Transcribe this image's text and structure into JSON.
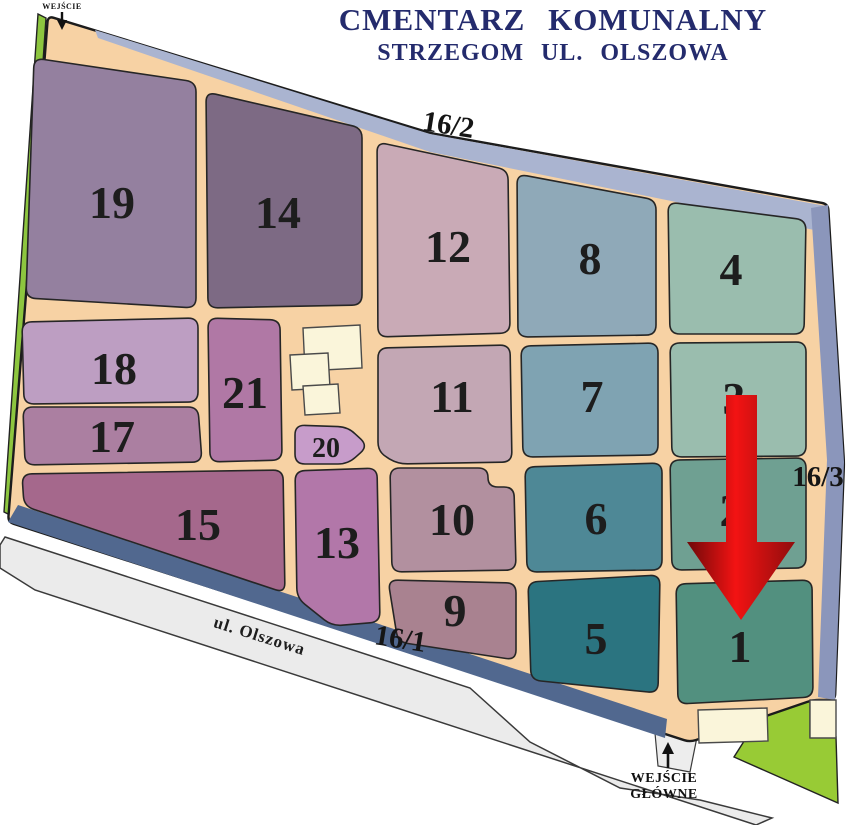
{
  "title": {
    "line1": "CMENTARZ KOMUNALNY",
    "line2": "STRZEGOM UL. OLSZOWA",
    "color": "#242b6d"
  },
  "map": {
    "ground_color": "#f7d2a4",
    "outline_color": "#1c1c1c",
    "number_color": "#1d1d1d",
    "boundary": [
      [
        48,
        16
      ],
      [
        430,
        133
      ],
      [
        828,
        204
      ],
      [
        844,
        462
      ],
      [
        835,
        700
      ],
      [
        813,
        700
      ],
      [
        690,
        742
      ],
      [
        8,
        522
      ]
    ],
    "strips": [
      {
        "name": "north-road-strip",
        "color": "#aab4d0",
        "points": [
          [
            95,
            30
          ],
          [
            430,
            134
          ],
          [
            826,
            206
          ],
          [
            824,
            232
          ],
          [
            430,
            152
          ],
          [
            98,
            38
          ]
        ]
      },
      {
        "name": "east-road-strip",
        "color": "#8b96bb",
        "points": [
          [
            828,
            205
          ],
          [
            844,
            462
          ],
          [
            835,
            700
          ],
          [
            818,
            697
          ],
          [
            827,
            460
          ],
          [
            811,
            208
          ]
        ]
      },
      {
        "name": "south-road-strip",
        "color": "#51688f",
        "points": [
          [
            8,
            522
          ],
          [
            665,
            738
          ],
          [
            667,
            719
          ],
          [
            18,
            505
          ]
        ]
      }
    ],
    "greens": [
      {
        "name": "green-strip-west",
        "color": "#8dc63f",
        "points": [
          [
            38,
            14
          ],
          [
            46,
            18
          ],
          [
            12,
            516
          ],
          [
            4,
            512
          ]
        ]
      },
      {
        "name": "green-area-southeast",
        "color": "#98cb35",
        "points": [
          [
            762,
            713
          ],
          [
            810,
            701
          ],
          [
            810,
            737
          ],
          [
            836,
            737
          ],
          [
            838,
            803
          ],
          [
            734,
            757
          ]
        ]
      }
    ],
    "road": {
      "color": "#ebebeb",
      "outline": "#3a3a3a",
      "points": [
        [
          5,
          537
        ],
        [
          470,
          688
        ],
        [
          530,
          742
        ],
        [
          620,
          788
        ],
        [
          700,
          800
        ],
        [
          772,
          818
        ],
        [
          756,
          825
        ],
        [
          35,
          590
        ],
        [
          0,
          568
        ],
        [
          0,
          545
        ]
      ],
      "label": {
        "text": "ul. Olszowa",
        "x": 258,
        "y": 641,
        "rotate": 17.5
      }
    },
    "driveway": {
      "color": "#ededed",
      "outline": "#3a3a3a",
      "points": [
        [
          655,
          733
        ],
        [
          697,
          737
        ],
        [
          690,
          772
        ],
        [
          658,
          766
        ]
      ]
    },
    "buildings": {
      "color": "#faf5da",
      "outline": "#4a4a4a",
      "list": [
        {
          "points": [
            [
              303,
              328
            ],
            [
              360,
              325
            ],
            [
              362,
              368
            ],
            [
              305,
              371
            ]
          ]
        },
        {
          "points": [
            [
              290,
              355
            ],
            [
              328,
              353
            ],
            [
              330,
              388
            ],
            [
              292,
              390
            ]
          ]
        },
        {
          "points": [
            [
              303,
              386
            ],
            [
              338,
              384
            ],
            [
              340,
              413
            ],
            [
              305,
              415
            ]
          ]
        },
        {
          "points": [
            [
              698,
              710
            ],
            [
              767,
              708
            ],
            [
              768,
              741
            ],
            [
              699,
              743
            ]
          ]
        },
        {
          "points": [
            [
              810,
              700
            ],
            [
              836,
              700
            ],
            [
              836,
              738
            ],
            [
              810,
              738
            ]
          ]
        }
      ]
    },
    "sections": [
      {
        "id": "19",
        "label": "19",
        "color": "#94809f",
        "points": [
          [
            34,
            58
          ],
          [
            196,
            82
          ],
          [
            196,
            308
          ],
          [
            26,
            298
          ]
        ],
        "lx": 112,
        "ly": 218,
        "size": 46
      },
      {
        "id": "14",
        "label": "14",
        "color": "#7d6a84",
        "points": [
          [
            206,
            92
          ],
          [
            362,
            128
          ],
          [
            362,
            305
          ],
          [
            208,
            308
          ]
        ],
        "lx": 278,
        "ly": 228,
        "size": 46
      },
      {
        "id": "12",
        "label": "12",
        "color": "#c9aab6",
        "points": [
          [
            377,
            142
          ],
          [
            508,
            170
          ],
          [
            510,
            333
          ],
          [
            378,
            337
          ]
        ],
        "lx": 448,
        "ly": 262,
        "size": 46
      },
      {
        "id": "8",
        "label": "8",
        "color": "#8fa9b8",
        "points": [
          [
            517,
            174
          ],
          [
            656,
            200
          ],
          [
            656,
            335
          ],
          [
            518,
            337
          ]
        ],
        "lx": 590,
        "ly": 274,
        "size": 46
      },
      {
        "id": "4",
        "label": "4",
        "color": "#9abdae",
        "points": [
          [
            668,
            202
          ],
          [
            806,
            220
          ],
          [
            804,
            334
          ],
          [
            670,
            334
          ]
        ],
        "lx": 731,
        "ly": 285,
        "size": 46
      },
      {
        "id": "18",
        "label": "18",
        "color": "#bd9ec2",
        "points": [
          [
            22,
            322
          ],
          [
            198,
            318
          ],
          [
            198,
            402
          ],
          [
            24,
            404
          ]
        ],
        "lx": 114,
        "ly": 384,
        "size": 46
      },
      {
        "id": "17",
        "label": "17",
        "color": "#ab7fa1",
        "points": [
          [
            23,
            407
          ],
          [
            198,
            407
          ],
          [
            202,
            462
          ],
          [
            25,
            465
          ]
        ],
        "lx": 112,
        "ly": 452,
        "size": 46
      },
      {
        "id": "21",
        "label": "21",
        "color": "#b078a5",
        "points": [
          [
            208,
            318
          ],
          [
            280,
            320
          ],
          [
            282,
            460
          ],
          [
            210,
            462
          ]
        ],
        "lx": 245,
        "ly": 408,
        "size": 46
      },
      {
        "id": "20",
        "label": "20",
        "color": "#c79cca",
        "points": [
          [
            295,
            425
          ],
          [
            348,
            427
          ],
          [
            368,
            446
          ],
          [
            348,
            464
          ],
          [
            295,
            464
          ]
        ],
        "lx": 326,
        "ly": 457,
        "size": 28
      },
      {
        "id": "11",
        "label": "11",
        "color": "#c3a7b4",
        "points": [
          [
            378,
            348
          ],
          [
            510,
            345
          ],
          [
            512,
            462
          ],
          [
            398,
            464
          ],
          [
            378,
            452
          ]
        ],
        "lx": 452,
        "ly": 412,
        "size": 46
      },
      {
        "id": "7",
        "label": "7",
        "color": "#7fa3b2",
        "points": [
          [
            521,
            346
          ],
          [
            658,
            343
          ],
          [
            658,
            455
          ],
          [
            523,
            457
          ]
        ],
        "lx": 592,
        "ly": 412,
        "size": 46
      },
      {
        "id": "3",
        "label": "3",
        "color": "#9abdae",
        "points": [
          [
            670,
            343
          ],
          [
            806,
            342
          ],
          [
            806,
            456
          ],
          [
            672,
            457
          ]
        ],
        "lx": 734,
        "ly": 414,
        "size": 46
      },
      {
        "id": "15",
        "label": "15",
        "color": "#a5688c",
        "points": [
          [
            22,
            474
          ],
          [
            283,
            470
          ],
          [
            285,
            593
          ],
          [
            24,
            506
          ]
        ],
        "lx": 198,
        "ly": 540,
        "size": 46
      },
      {
        "id": "13",
        "label": "13",
        "color": "#b277a9",
        "points": [
          [
            295,
            471
          ],
          [
            377,
            468
          ],
          [
            380,
            622
          ],
          [
            332,
            626
          ],
          [
            297,
            598
          ]
        ],
        "lx": 337,
        "ly": 558,
        "size": 46
      },
      {
        "id": "10",
        "label": "10",
        "color": "#b2909f",
        "points": [
          [
            390,
            468
          ],
          [
            488,
            468
          ],
          [
            488,
            487
          ],
          [
            514,
            487
          ],
          [
            516,
            570
          ],
          [
            392,
            572
          ]
        ],
        "lx": 452,
        "ly": 535,
        "size": 46
      },
      {
        "id": "9",
        "label": "9",
        "color": "#a98290",
        "points": [
          [
            388,
            580
          ],
          [
            516,
            583
          ],
          [
            516,
            660
          ],
          [
            398,
            642
          ]
        ],
        "lx": 455,
        "ly": 626,
        "size": 46
      },
      {
        "id": "6",
        "label": "6",
        "color": "#4e8896",
        "points": [
          [
            525,
            467
          ],
          [
            662,
            463
          ],
          [
            662,
            570
          ],
          [
            527,
            572
          ]
        ],
        "lx": 596,
        "ly": 534,
        "size": 46
      },
      {
        "id": "2",
        "label": "2",
        "color": "#6fa092",
        "points": [
          [
            670,
            460
          ],
          [
            806,
            458
          ],
          [
            806,
            568
          ],
          [
            672,
            570
          ]
        ],
        "lx": 731,
        "ly": 526,
        "size": 46
      },
      {
        "id": "5",
        "label": "5",
        "color": "#2b7480",
        "points": [
          [
            528,
            582
          ],
          [
            660,
            575
          ],
          [
            658,
            693
          ],
          [
            531,
            680
          ]
        ],
        "lx": 596,
        "ly": 654,
        "size": 46
      },
      {
        "id": "1",
        "label": "1",
        "color": "#52907f",
        "points": [
          [
            676,
            584
          ],
          [
            812,
            580
          ],
          [
            813,
            697
          ],
          [
            678,
            704
          ]
        ],
        "lx": 740,
        "ly": 662,
        "size": 46
      }
    ],
    "plot_labels": [
      {
        "text": "16/2",
        "x": 447,
        "y": 134,
        "rotate": 9
      },
      {
        "text": "16/1",
        "x": 399,
        "y": 648,
        "rotate": 9
      },
      {
        "text": "16/3",
        "x": 818,
        "y": 486,
        "rotate": 0
      }
    ],
    "arrow": {
      "name": "pointer-arrow",
      "edge_color": "#6e0909",
      "mid_color": "#f31313",
      "edge2_color": "#900d0d",
      "shaft": {
        "x1": 726,
        "x2": 757,
        "top": 395,
        "bottom": 542
      },
      "head": {
        "left": 687,
        "right": 795,
        "tip_x": 741,
        "tip_y": 620
      }
    },
    "entrances": {
      "north": {
        "text": "WEJŚCIE",
        "x": 62,
        "y": 9
      },
      "main": {
        "line1": "WEJŚCIE",
        "line2": "GŁÓWNE",
        "x": 664,
        "y1": 782,
        "y2": 798
      }
    }
  }
}
